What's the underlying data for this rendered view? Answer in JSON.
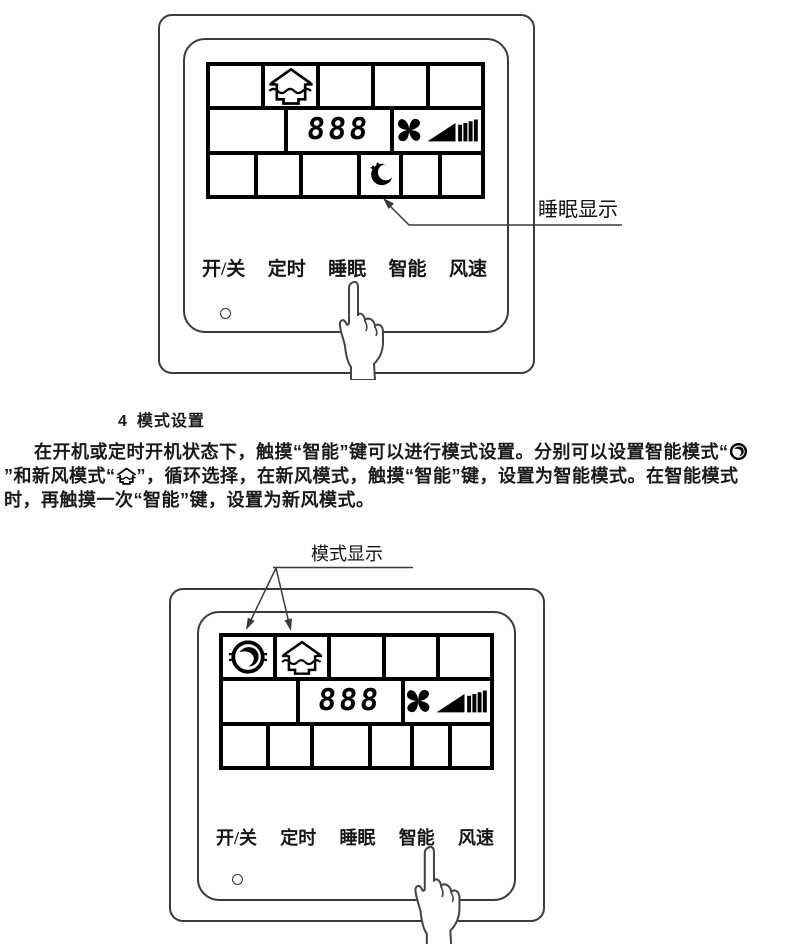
{
  "page": {
    "background": "#ffffff",
    "line_color": "#3a3a3a",
    "lcd_color": "#000000"
  },
  "callouts": {
    "sleep_label": "睡眠显示",
    "mode_label": "模式显示"
  },
  "section": {
    "number": "4",
    "title": "模式设置",
    "body_part1": "在开机或定时开机状态下，触摸“智能”键可以进行模式设置。分别可以设置智能模式“",
    "body_part2": "”和新风模式“",
    "body_part3": "”，循环选择，在新风模式，触摸“智能”键，设置为智能模式。在智能模式时，再触摸一次“智能”键，设置为新风模式。"
  },
  "top_panel": {
    "display_value": "888",
    "buttons": [
      "开/关",
      "定时",
      "睡眠",
      "智能",
      "风速"
    ],
    "lcd_icons": [
      "fresh-air-house-icon",
      "fan-blades-icon",
      "speed-ramp-icon",
      "moon-stars-icon"
    ]
  },
  "bottom_panel": {
    "display_value": "888",
    "buttons": [
      "开/关",
      "定时",
      "睡眠",
      "智能",
      "风速"
    ],
    "lcd_icons": [
      "smart-mode-swirl-icon",
      "fresh-air-house-icon",
      "fan-blades-icon",
      "speed-ramp-icon"
    ]
  },
  "icons": {
    "fresh_air_mode": "house-airflow-icon",
    "smart_mode": "swirl-circle-icon",
    "fan_speed": "fan-blades-with-ramp-icon",
    "sleep": "moon-stars-icon",
    "power_indicator": "led-dot",
    "pointer": "pointing-hand-icon"
  }
}
